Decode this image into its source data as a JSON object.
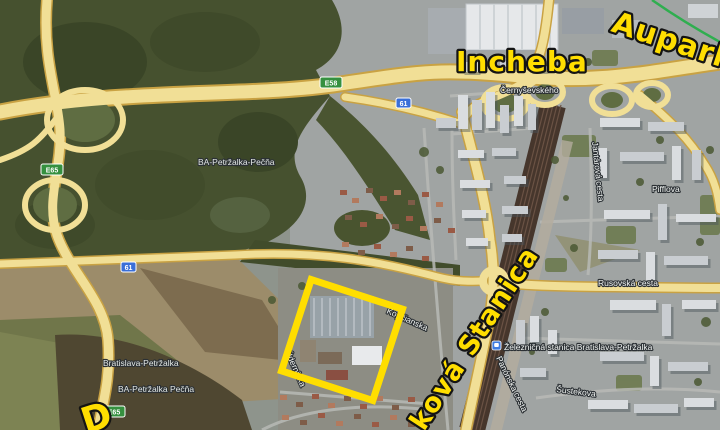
{
  "colors": {
    "annotation_yellow": "#ffde00",
    "highlight_yellow": "#ffde00",
    "park_green": "#2fae4f",
    "shield_green": "#35903f",
    "shield_blue": "#3a6fd8",
    "road_yellow": "#f1df96"
  },
  "annotations": {
    "incheba": "Incheba",
    "aupark": "Aupark",
    "stanica_rotated": "ková Stanica",
    "partial_letter": "D"
  },
  "place_labels": {
    "ba_petrzalka_pecna_forest": "BA-Petržalka-Pečňa",
    "bratislava_petrzalka": "Bratislava-Petržalka",
    "ba_petrzalka_pecna_field": "BA-Petržalka Pečňa",
    "railway_station": "Železničná stanica Bratislava-Petržalka",
    "pifflova": "Pifflova",
    "rusovska_cesta": "Rusovská cesta",
    "cernysevskeho": "Černyševského",
    "sustekova": "Šustekova",
    "panonska_cesta": "Panónska cesta",
    "jantarova_cesta": "Jantárová cesta",
    "kopcianska": "Kopčianska",
    "udernicka": "Údernícka"
  },
  "road_shields": {
    "e58": "E58",
    "e65_upper": "E65",
    "e65_lower": "E65",
    "r61_upper": "61",
    "r61_lower": "61"
  }
}
